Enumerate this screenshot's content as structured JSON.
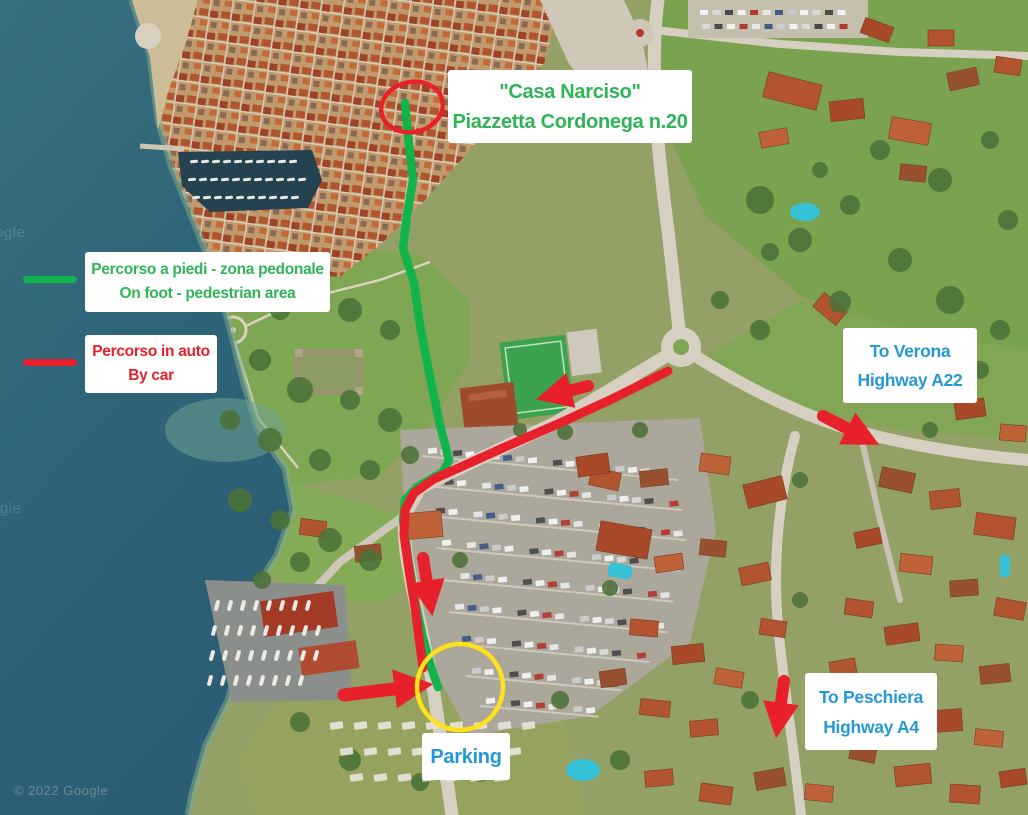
{
  "map": {
    "destination_label": {
      "line1": "\"Casa Narciso\"",
      "line2": "Piazzetta Cordonega n.20",
      "text_color": "#2fb457"
    },
    "legend": {
      "walk": {
        "line1": "Percorso a piedi - zona pedonale",
        "line2": "On foot - pedestrian area",
        "swatch_color": "#11b34b",
        "text_color": "#2fb457"
      },
      "car": {
        "line1": "Percorso in auto",
        "line2": "By car",
        "swatch_color": "#e8202b",
        "text_color": "#e8202b"
      }
    },
    "directions": {
      "verona": {
        "line1": "To Verona",
        "line2": "Highway A22",
        "text_color": "#2598d5"
      },
      "peschiera": {
        "line1": "To Peschiera",
        "line2": "Highway A4",
        "text_color": "#2598d5"
      },
      "parking": {
        "label": "Parking",
        "text_color": "#2598d5"
      }
    },
    "annotations": {
      "route_walk_color": "#11b34b",
      "route_car_color": "#e8202b",
      "destination_circle_color": "#e8202b",
      "parking_circle_color": "#ffe11c"
    },
    "watermark": {
      "copyright": "© 2022 Google",
      "tile": "Google"
    }
  }
}
